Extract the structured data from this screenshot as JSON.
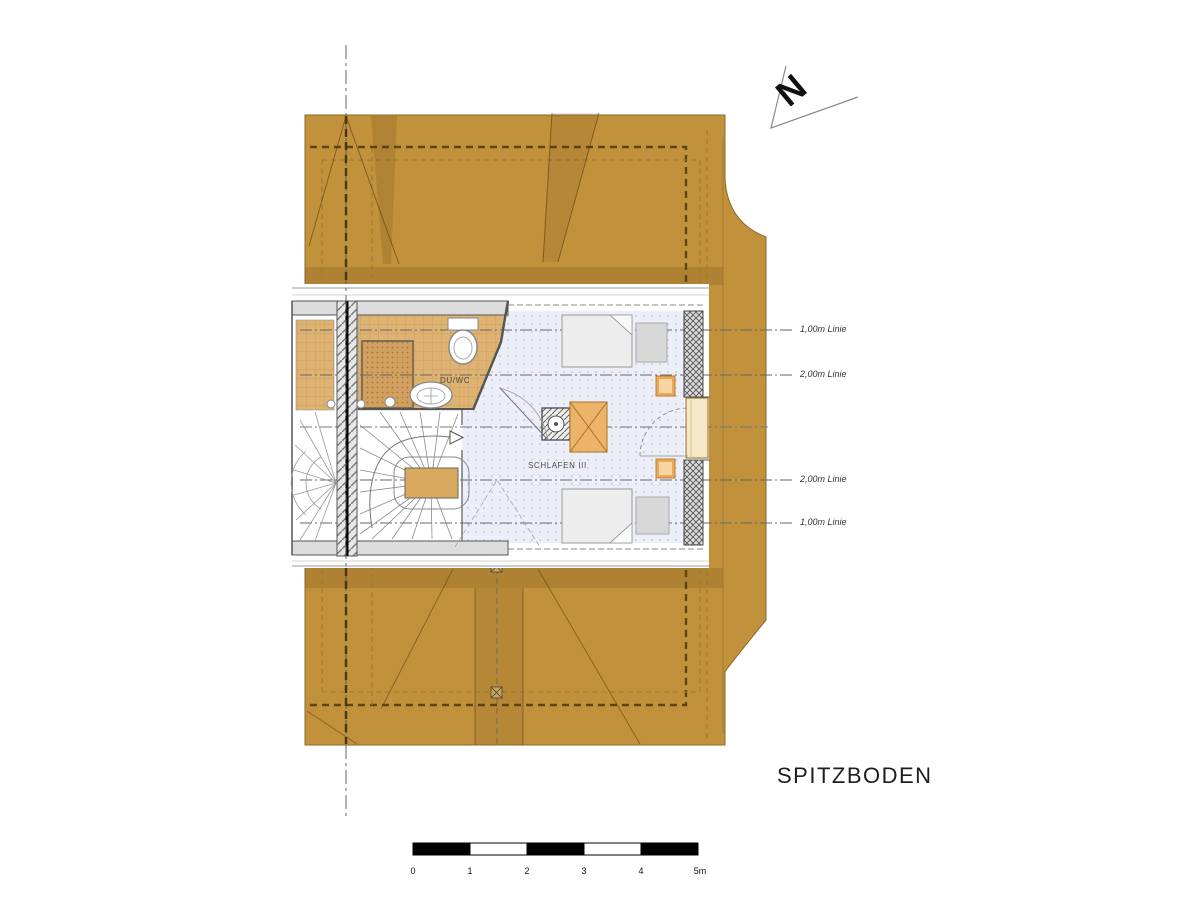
{
  "title": "SPITZBODEN",
  "north_arrow": {
    "label": "N"
  },
  "rooms": {
    "bathroom": {
      "label": "DU/WC"
    },
    "bedroom": {
      "label": "SCHLAFEN III"
    }
  },
  "dimension_lines": [
    {
      "label": "1,00m Linie"
    },
    {
      "label": "2,00m Linie"
    },
    {
      "label": "2,00m Linie"
    },
    {
      "label": "1,00m Linie"
    }
  ],
  "scale_bar": {
    "unit_labels": [
      "0",
      "1",
      "2",
      "3",
      "4",
      "5m"
    ]
  },
  "colors": {
    "roof": "#C2913C",
    "roof_line": "#8a6a28",
    "floor_wood": "#DDB272",
    "floor_bedroom": "#EDEFF8",
    "wall_gray": "#DCDCDC",
    "furniture_orange": "#E9A85C",
    "text": "#222222"
  }
}
